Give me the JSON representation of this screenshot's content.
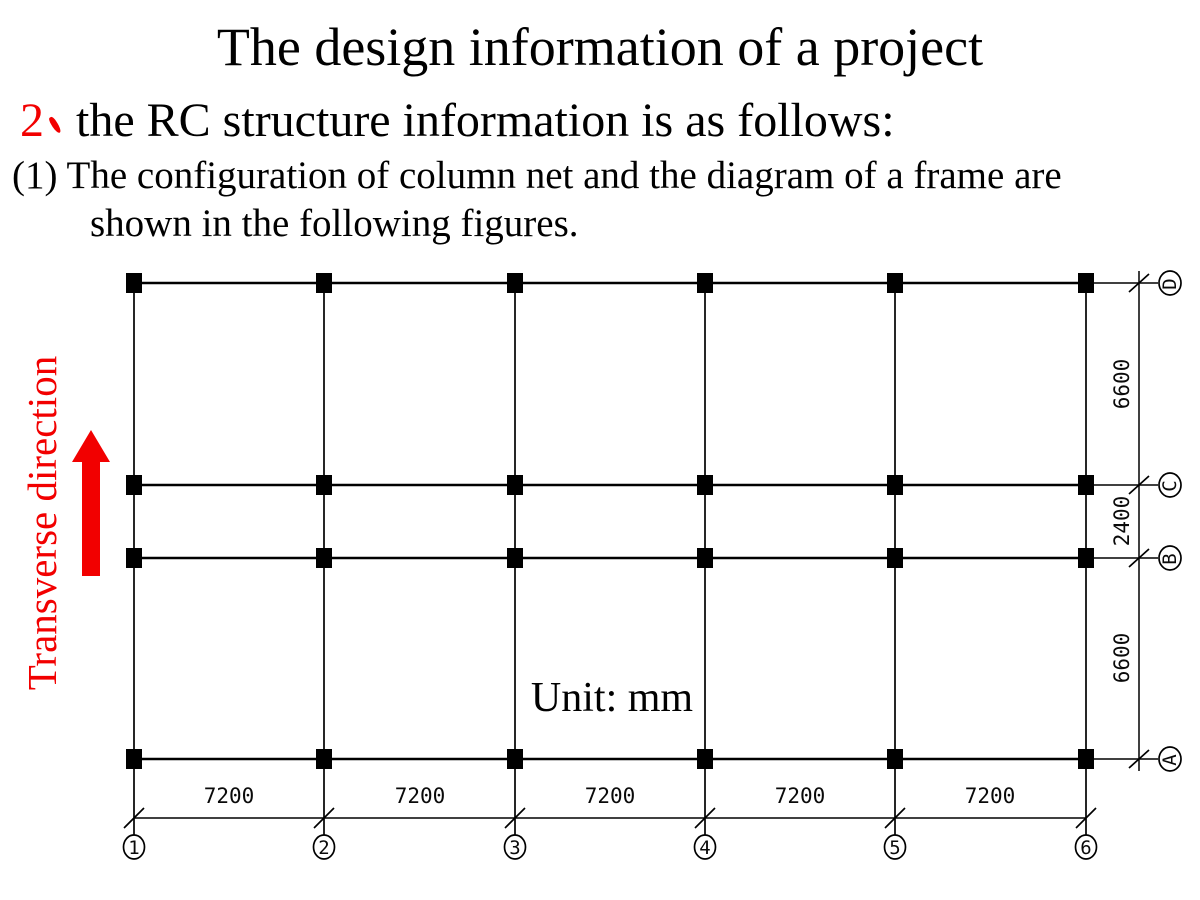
{
  "colors": {
    "accent_red": "#f20000",
    "ink": "#000000",
    "background": "#ffffff"
  },
  "header": {
    "title": "The design information of a project",
    "item_number": "2",
    "item_comma": "、",
    "item_text": "the RC structure information is as follows:",
    "para_line1": "(1) The configuration of column net and the diagram of a frame are",
    "para_line2": "shown in the following figures."
  },
  "diagram": {
    "transverse_label": "Transverse direction",
    "unit_label": "Unit: mm",
    "bottom_axes": [
      "1",
      "2",
      "3",
      "4",
      "5",
      "6"
    ],
    "right_axes": [
      "D",
      "C",
      "B",
      "A"
    ],
    "bottom_dims": [
      "7200",
      "7200",
      "7200",
      "7200",
      "7200"
    ],
    "right_dims": [
      "6600",
      "2400",
      "6600"
    ]
  }
}
